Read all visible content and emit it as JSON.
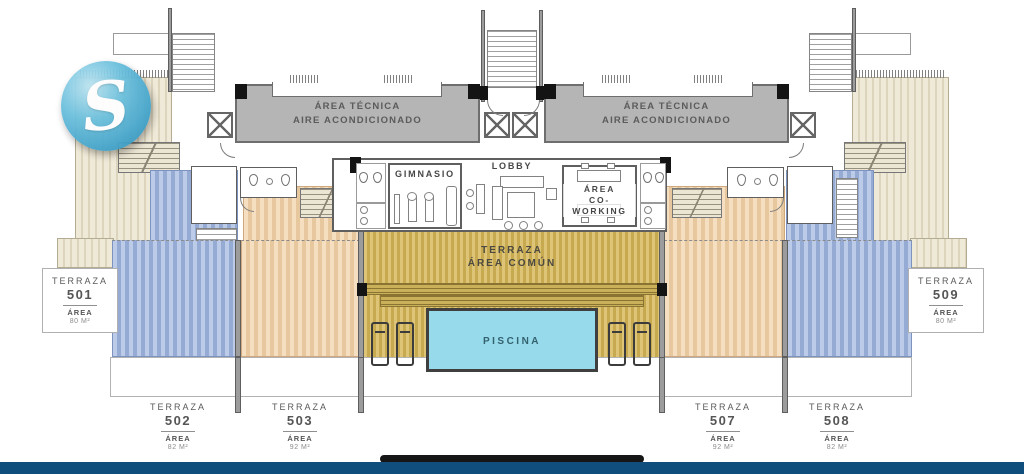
{
  "logo": {
    "letter": "S"
  },
  "plan": {
    "technical_areas": [
      {
        "line1": "ÁREA TÉCNICA",
        "line2": "AIRE ACONDICIONADO"
      },
      {
        "line1": "ÁREA TÉCNICA",
        "line2": "AIRE ACONDICIONADO"
      }
    ],
    "gym_label": "GIMNASIO",
    "lobby_label": "LOBBY",
    "coworking": {
      "line1": "ÁREA",
      "line2": "CO-WORKING"
    },
    "common_terrace": {
      "line1": "TERRAZA",
      "line2": "ÁREA COMÚN"
    },
    "pool_label": "PISCINA"
  },
  "units": [
    {
      "label": "TERRAZA",
      "number": "501",
      "area_label": "ÁREA",
      "area_value": "80 M²"
    },
    {
      "label": "TERRAZA",
      "number": "502",
      "area_label": "ÁREA",
      "area_value": "82 M²"
    },
    {
      "label": "TERRAZA",
      "number": "503",
      "area_label": "ÁREA",
      "area_value": "92 M²"
    },
    {
      "label": "TERRAZA",
      "number": "507",
      "area_label": "ÁREA",
      "area_value": "92 M²"
    },
    {
      "label": "TERRAZA",
      "number": "508",
      "area_label": "ÁREA",
      "area_value": "82 M²"
    },
    {
      "label": "TERRAZA",
      "number": "509",
      "area_label": "ÁREA",
      "area_value": "80 M²"
    }
  ],
  "colors": {
    "cream_terrace": "#efe9d8",
    "blue_terrace": "#a9bede",
    "peach_terrace": "#f2d9b8",
    "olive_terrace": "#d8bd6c",
    "pool_blue": "#97daeb",
    "technical_gray": "#b5b5b5",
    "wall_gray": "#9c9c9c",
    "footer_blue": "#0f4e7d",
    "logo_blue": "#46a5cb"
  }
}
